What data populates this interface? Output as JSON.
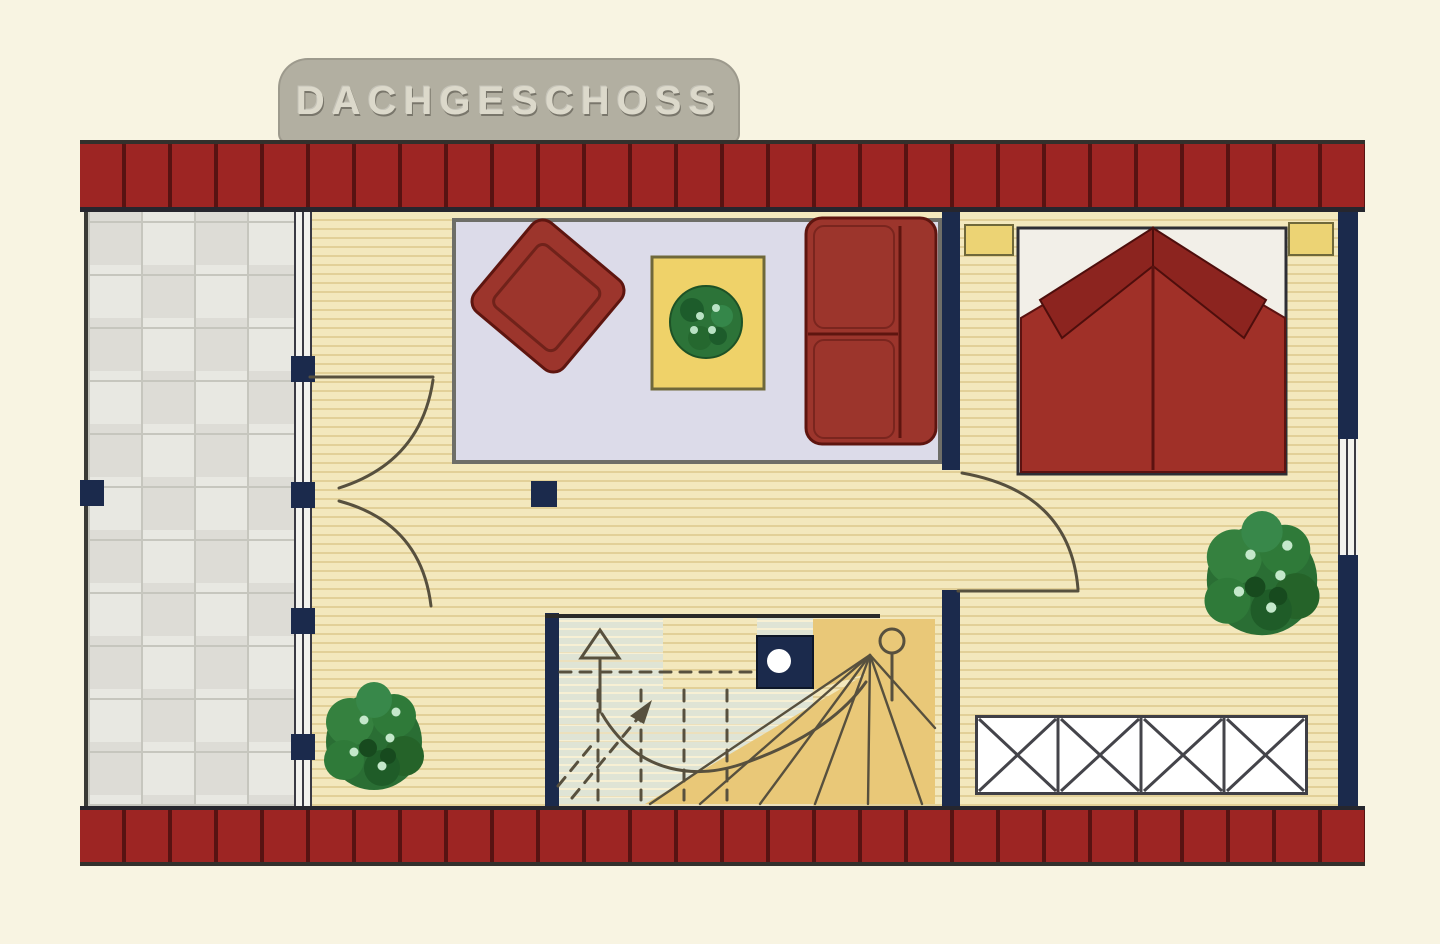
{
  "title": {
    "label": "DACHGESCHOSS"
  },
  "colors": {
    "page_bg": "#f8f4e2",
    "tab_bg": "#b2afa1",
    "tab_text": "#dcd9cb",
    "brick_red": "#9d2523",
    "brick_line": "#571312",
    "band_edge": "#26262e",
    "navy": "#1b2a4c",
    "wood": "#f3e8bd",
    "wood_line": "#e2d098",
    "tile": "#e8e8e2",
    "tile_alt": "#dddcd6",
    "grout": "#c6c6be",
    "rug": "#dcdbe9",
    "rug_border": "#6e6e68",
    "furniture_red": "#9c352c",
    "furniture_dark": "#5e150f",
    "duvet_red": "#a03028",
    "pillow_red": "#8c241f",
    "mattress": "#f2efe8",
    "table_yellow": "#efd269",
    "side_table_yellow": "#ecd374",
    "plant_green": "#2c7338",
    "stair_sage": "#dfe4d5",
    "stair_tan": "#e9c878",
    "line_olive": "#57503e",
    "white": "#ffffff"
  }
}
